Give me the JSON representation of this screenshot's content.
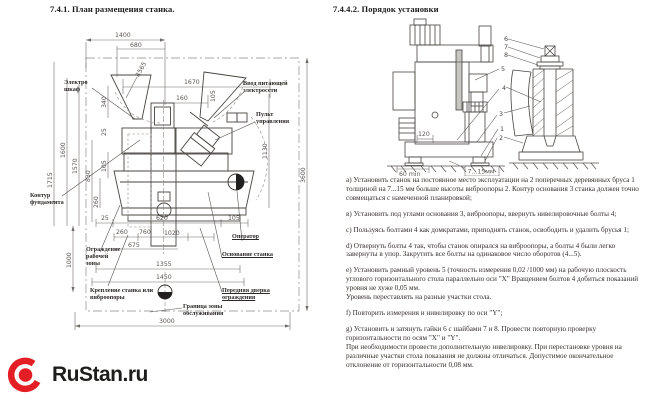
{
  "left": {
    "title": "7.4.1. План размещения станка.",
    "dims": {
      "t1400": "1400",
      "t680": "680",
      "r565": "R565",
      "t1670": "1670",
      "t160": "160",
      "t105r": "105",
      "t340": "340",
      "t25l": "25",
      "t105l": "105",
      "t260l": "260",
      "t830": "830",
      "t1600": "1600",
      "t1570": "1570",
      "t1715": "1715",
      "t1130": "1130",
      "t3600": "3600",
      "t25b": "25",
      "t620": "620",
      "t105b": "105",
      "t260c": "260",
      "t760": "760",
      "t1020": "1020",
      "t675": "675",
      "t1355": "1355",
      "t1450": "1450",
      "t1000": "1000",
      "t3000": "3000"
    },
    "labels": {
      "cabinet": "Электро\nшкаф",
      "power": "Ввод питающей\nэлектросети",
      "pult": "Пульт\nуправления",
      "foundation": "Контур\nфундамента",
      "guard": "Ограждение\nрабочей\nзоны",
      "mount": "Крепление станка или\nвиброопоры",
      "zone": "Граница зоны\nобслуживания",
      "operator": "Оператор",
      "base": "Основание станка",
      "door": "Передняя дверка\nограждения"
    }
  },
  "right": {
    "title": "7.4.4.2. Порядок установки",
    "dims": {
      "d120": "120",
      "d60": "60 min",
      "gap": "7...15мм"
    },
    "callouts": {
      "c6": "6",
      "c7": "7",
      "c8": "8",
      "c5": "5",
      "c4": "4",
      "c3": "3",
      "c1": "1",
      "c2": "2"
    },
    "steps": [
      "а) Установить станок на постоянное место эксплуатации на 2 поперечных деревянных бруса 1 толщиной на 7...15 мм больше высоты виброопоры 2. Контур основания 3 станка должен точно совмещаться с намеченной планировкой;",
      "в) Установить под углами основания 3, виброопоры, ввернуть нивелировочные болты 4;",
      "с) Пользуясь болтами 4 как домкратами, приподнять станок, освободить и удалить брусья 1;",
      "d) Отвернуть болты 4 так, чтобы станок опирался на виброопоры, а болты 4 были легко завернуты в упор. Закрутить все болты на одинаковое число оборотов (4...5).",
      "е) Установить рамный уровень 5 (точность измерения 0,02 /1000 мм) на рабочую плоскость углового горизонтального стола параллельно оси \"X\" Вращением болтов 4 добиться показаний уровня не хуже 0,05 мм.\nУровень переставлять на разные участки стола.",
      "f) Повторить измерения и нивелировку по оси \"Y\";",
      "g) Установить и затянуть гайки 6 с шайбами 7 и 8. Провести повторную проверку горизонтальности по осям \"X\" и \"Y\".\nПри необходимости провести дополнительную нивелировку. При перестановке уровня на различные участки стола показания не должны отличаться. Допустимое окончательное отклонение от горизонтальности 0,08 мм."
    ]
  },
  "logo": {
    "text": "RuStan.ru",
    "accent": "#e31e24",
    "text_color": "#1d1d1b"
  }
}
